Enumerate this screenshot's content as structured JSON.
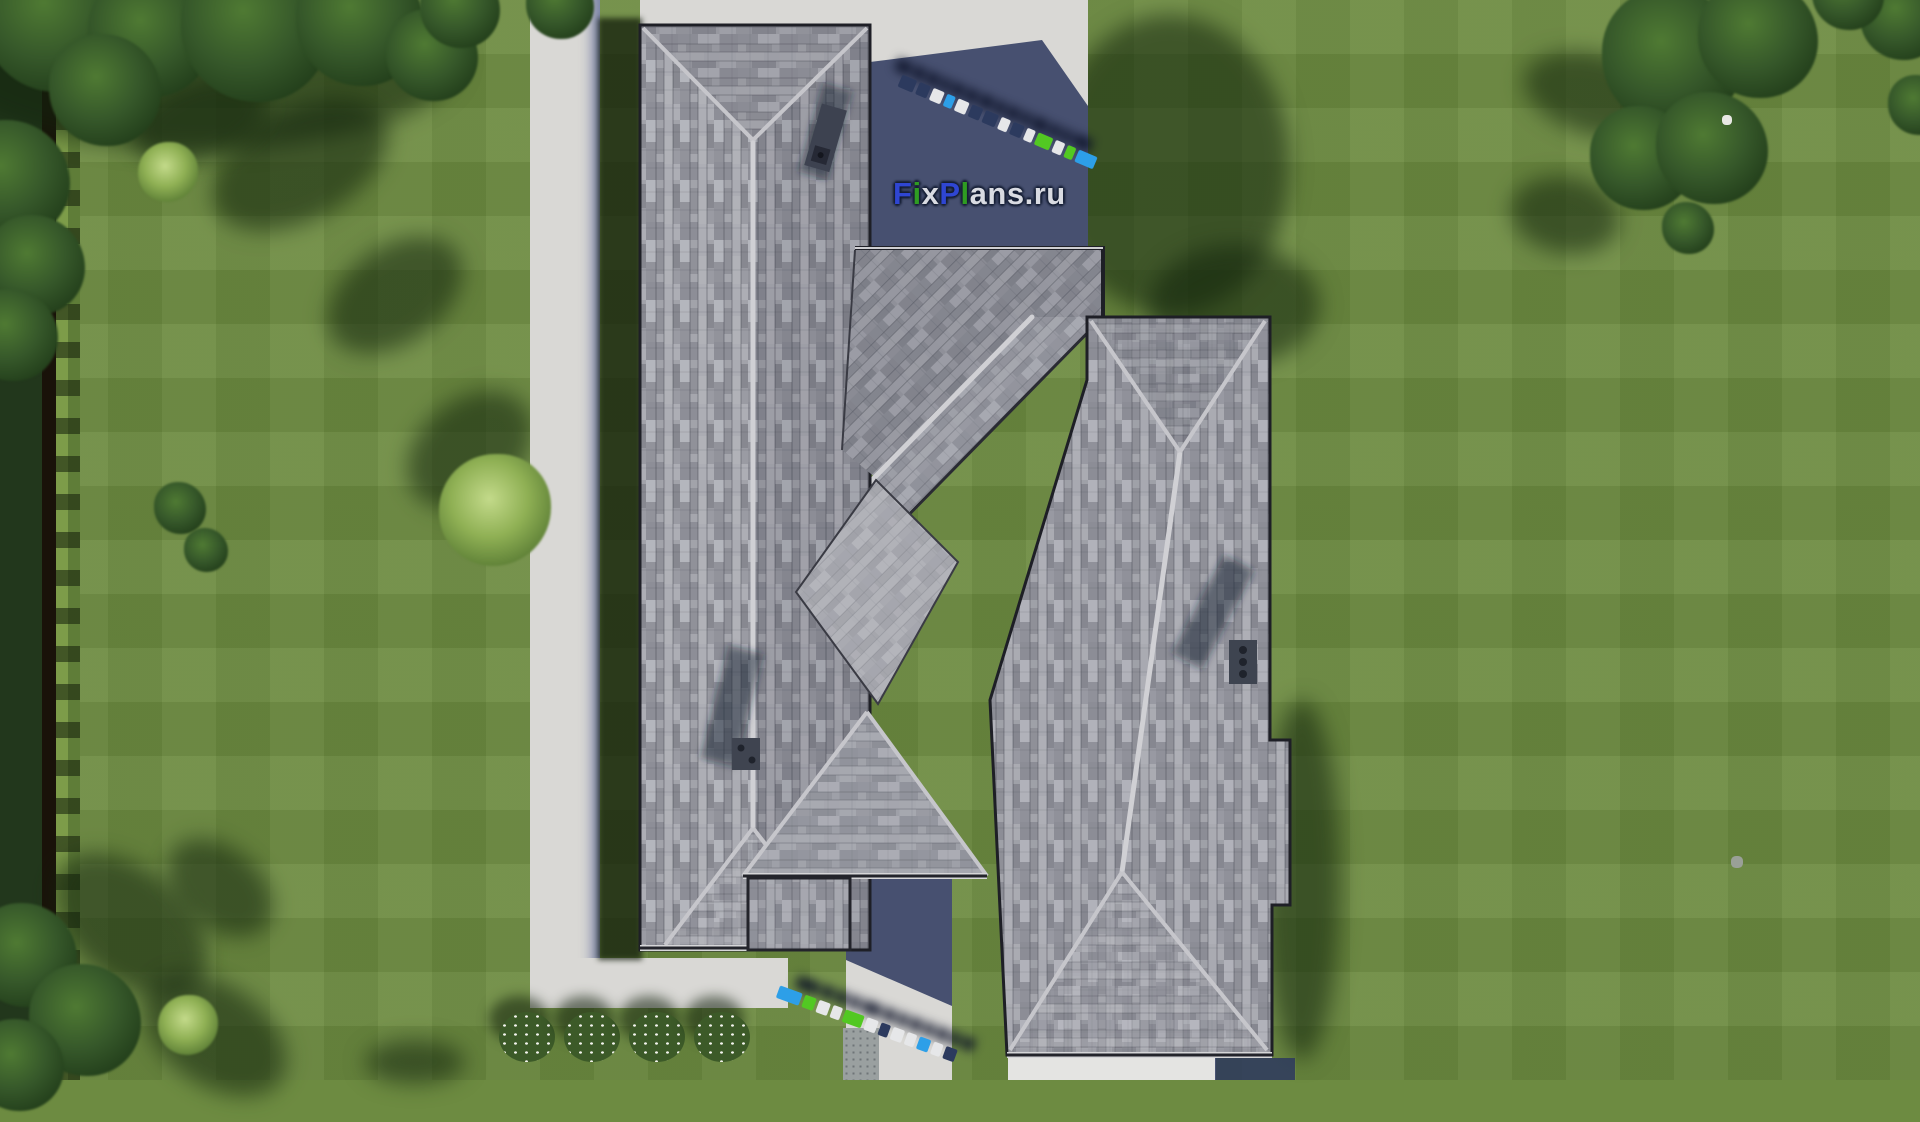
{
  "watermark": {
    "text": "FixPlans.ru",
    "letters": [
      {
        "ch": "F",
        "tone": "blue"
      },
      {
        "ch": "i",
        "tone": "green"
      },
      {
        "ch": "x",
        "tone": "light"
      },
      {
        "ch": "P",
        "tone": "blue"
      },
      {
        "ch": "l",
        "tone": "green"
      },
      {
        "ch": "a",
        "tone": "light"
      },
      {
        "ch": "n",
        "tone": "light"
      },
      {
        "ch": "s",
        "tone": "light"
      },
      {
        "ch": ".",
        "tone": "light"
      },
      {
        "ch": "r",
        "tone": "light"
      },
      {
        "ch": "u",
        "tone": "light"
      }
    ],
    "outline_color": "#141d33",
    "letter_colors": {
      "blue": "#2f46d2",
      "green": "#2f9c22",
      "light": "#d9dbe2"
    }
  },
  "palette": {
    "grass": "#6d8b41",
    "grass_shadow": "#1c2c12",
    "hedge_dark": "#22371c",
    "hedge_light": "#7d9c49",
    "path": "#d9d8d5",
    "path_shadow": "#2d385e",
    "roof_light": "#b2b3b9",
    "roof_mid": "#97979d",
    "roof_dark": "#767882",
    "ridge": "#d0d0d4",
    "eave": "#1e1f26",
    "chimney": "#3d4250",
    "logo_navy": "#2c3a5e",
    "logo_white": "#e6e7e9",
    "logo_green": "#52c822",
    "logo_sky": "#2d9fe8"
  },
  "scenery": {
    "trees": [
      {
        "x": 55,
        "y": 20,
        "r": 72,
        "type": "tree"
      },
      {
        "x": 150,
        "y": 35,
        "r": 62,
        "type": "tree"
      },
      {
        "x": 255,
        "y": 28,
        "r": 74,
        "type": "tree"
      },
      {
        "x": 360,
        "y": 22,
        "r": 64,
        "type": "tree"
      },
      {
        "x": 432,
        "y": 55,
        "r": 46,
        "type": "tree"
      },
      {
        "x": 105,
        "y": 90,
        "r": 56,
        "type": "tree"
      },
      {
        "x": 10,
        "y": 180,
        "r": 60,
        "type": "tree"
      },
      {
        "x": 35,
        "y": 265,
        "r": 50,
        "type": "tree"
      },
      {
        "x": 12,
        "y": 335,
        "r": 46,
        "type": "tree"
      },
      {
        "x": 460,
        "y": 8,
        "r": 40,
        "type": "tree"
      },
      {
        "x": 560,
        "y": 5,
        "r": 34,
        "type": "tree"
      },
      {
        "x": 25,
        "y": 955,
        "r": 52,
        "type": "tree"
      },
      {
        "x": 85,
        "y": 1020,
        "r": 56,
        "type": "tree"
      },
      {
        "x": 18,
        "y": 1065,
        "r": 46,
        "type": "tree"
      },
      {
        "x": 1672,
        "y": 58,
        "r": 70,
        "type": "tree"
      },
      {
        "x": 1758,
        "y": 38,
        "r": 60,
        "type": "tree"
      },
      {
        "x": 1642,
        "y": 158,
        "r": 52,
        "type": "tree"
      },
      {
        "x": 1712,
        "y": 148,
        "r": 56,
        "type": "tree"
      },
      {
        "x": 1902,
        "y": 18,
        "r": 42,
        "type": "tree"
      },
      {
        "x": 1848,
        "y": -6,
        "r": 36,
        "type": "tree"
      },
      {
        "x": 1688,
        "y": 228,
        "r": 26,
        "type": "tree"
      },
      {
        "x": 1918,
        "y": 105,
        "r": 30,
        "type": "tree"
      },
      {
        "x": 180,
        "y": 508,
        "r": 26,
        "type": "tree"
      },
      {
        "x": 206,
        "y": 550,
        "r": 22,
        "type": "tree"
      },
      {
        "x": 495,
        "y": 510,
        "r": 56,
        "type": "bush-light"
      },
      {
        "x": 188,
        "y": 1025,
        "r": 30,
        "type": "bush-light"
      },
      {
        "x": 168,
        "y": 172,
        "r": 30,
        "type": "bush-light"
      }
    ],
    "shadows": [
      {
        "x": 200,
        "y": 60,
        "rx": 260,
        "ry": 90,
        "rot": 0
      },
      {
        "x": 300,
        "y": 165,
        "rx": 95,
        "ry": 55,
        "rot": -28
      },
      {
        "x": 395,
        "y": 295,
        "rx": 75,
        "ry": 48,
        "rot": -35
      },
      {
        "x": 470,
        "y": 450,
        "rx": 70,
        "ry": 50,
        "rot": -40
      },
      {
        "x": 200,
        "y": 120,
        "rx": 70,
        "ry": 40,
        "rot": -20
      },
      {
        "x": 1170,
        "y": 165,
        "rx": 120,
        "ry": 150,
        "rot": 0
      },
      {
        "x": 1235,
        "y": 305,
        "rx": 85,
        "ry": 60,
        "rot": 0
      },
      {
        "x": 1597,
        "y": 95,
        "rx": 75,
        "ry": 40,
        "rot": 15
      },
      {
        "x": 1565,
        "y": 215,
        "rx": 55,
        "ry": 38,
        "rot": 10
      },
      {
        "x": 130,
        "y": 925,
        "rx": 90,
        "ry": 55,
        "rot": 40
      },
      {
        "x": 215,
        "y": 1035,
        "rx": 80,
        "ry": 50,
        "rot": 35
      },
      {
        "x": 220,
        "y": 888,
        "rx": 60,
        "ry": 40,
        "rot": 40
      },
      {
        "x": 415,
        "y": 1062,
        "rx": 50,
        "ry": 22,
        "rot": 0
      },
      {
        "x": 1302,
        "y": 880,
        "rx": 38,
        "ry": 180,
        "rot": 0
      }
    ],
    "flowers": [
      {
        "x": 527,
        "y": 1037
      },
      {
        "x": 592,
        "y": 1037
      },
      {
        "x": 657,
        "y": 1037
      },
      {
        "x": 722,
        "y": 1037
      }
    ],
    "specks": [
      {
        "x": 1727,
        "y": 120,
        "r": 5,
        "color": "#e8e8e4"
      },
      {
        "x": 1737,
        "y": 862,
        "r": 6,
        "color": "#9aa097"
      }
    ],
    "logo_rows": [
      {
        "x": 900,
        "y": 74,
        "rot": 23,
        "dx": -10,
        "dy": -14,
        "blocks": [
          {
            "c": "navy",
            "w": 16
          },
          {
            "c": "navy",
            "w": 12
          },
          {
            "c": "white",
            "w": 12
          },
          {
            "c": "sky",
            "w": 9
          },
          {
            "c": "white",
            "w": 12
          },
          {
            "c": "navy",
            "w": 12
          },
          {
            "c": "navy",
            "w": 14
          },
          {
            "c": "white",
            "w": 10
          },
          {
            "c": "navy",
            "w": 12
          },
          {
            "c": "white",
            "w": 9
          },
          {
            "c": "green",
            "w": 16
          },
          {
            "c": "white",
            "w": 10
          },
          {
            "c": "green",
            "w": 9
          },
          {
            "c": "sky",
            "w": 20
          }
        ]
      },
      {
        "x": 778,
        "y": 985,
        "rot": 20,
        "dx": 14,
        "dy": -16,
        "blocks": [
          {
            "c": "sky",
            "w": 24
          },
          {
            "c": "green",
            "w": 12
          },
          {
            "c": "white",
            "w": 12
          },
          {
            "c": "white",
            "w": 10
          },
          {
            "c": "green",
            "w": 20
          },
          {
            "c": "white",
            "w": 12
          },
          {
            "c": "navy",
            "w": 10
          },
          {
            "c": "white",
            "w": 12
          },
          {
            "c": "white",
            "w": 10
          },
          {
            "c": "sky",
            "w": 12
          },
          {
            "c": "white",
            "w": 10
          },
          {
            "c": "navy",
            "w": 12
          }
        ]
      }
    ]
  }
}
